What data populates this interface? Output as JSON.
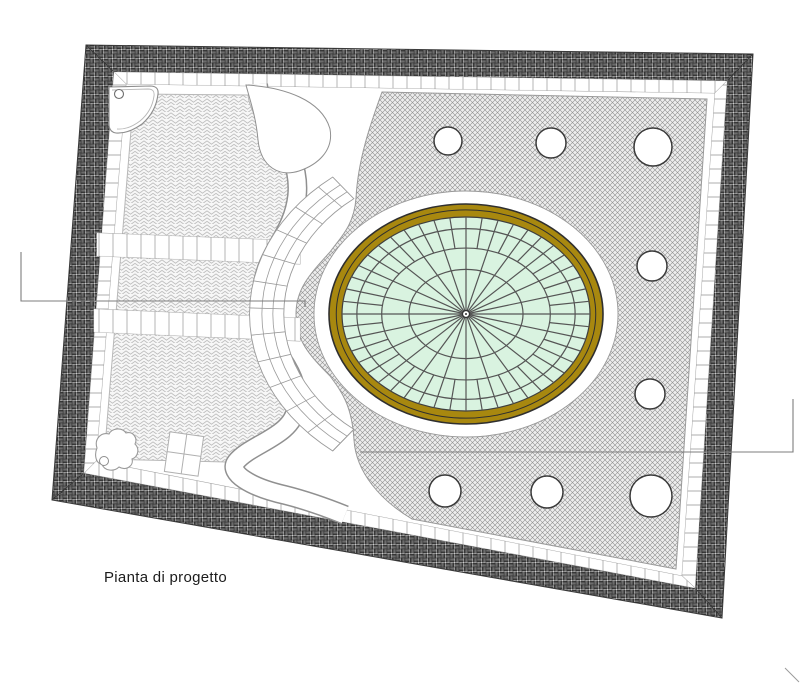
{
  "drawing": {
    "caption": "Pianta di progetto",
    "caption_pos": [
      104,
      569
    ],
    "colors": {
      "line": "#3a3a3a",
      "weave": "#222222",
      "weave_bg": "#f4f4f4",
      "hatch_line": "#8f8f8f",
      "hatch_bg": "#ededed",
      "herringbone_line": "#bdbdbd",
      "herringbone_bg": "#f7f7f7",
      "paver_joint": "#a3a3a3",
      "path_gray": "#909090",
      "soft_gray": "#b8b8b8",
      "ring_brown": "#A8880F",
      "ring_outline": "#2f2f2f",
      "dome_green": "#D9F3E0",
      "web_line": "#555555",
      "leader_gray": "#7d7d7d",
      "white": "#ffffff"
    },
    "outer_quad": [
      [
        86,
        45
      ],
      [
        753,
        54
      ],
      [
        722,
        618
      ],
      [
        52,
        500
      ]
    ],
    "inner_quad": [
      [
        114,
        72
      ],
      [
        727,
        81
      ],
      [
        695,
        588
      ],
      [
        84,
        473
      ]
    ],
    "content_quad": [
      [
        126,
        84
      ],
      [
        715,
        93
      ],
      [
        682,
        576
      ],
      [
        96,
        461
      ]
    ],
    "ellipse": {
      "cx": 466,
      "cy": 314,
      "ring_rx": 137,
      "ring_ry": 110,
      "inner_line_scale": 0.947,
      "green_rx": 124,
      "green_ry": 97,
      "white_rx": 152,
      "white_ry": 123,
      "web_rings": [
        0.46,
        0.68,
        0.88
      ],
      "spokes": 24,
      "sub_spokes_from": 0.68,
      "hub_radius": 3.5
    },
    "walkway": {
      "scale_in": 1.33,
      "scale_out": 1.58,
      "mid_scales": [
        1.41,
        1.49
      ],
      "deg_start": 128,
      "deg_end": 232,
      "joint_step": 9
    },
    "tree_circles": [
      [
        448,
        141,
        14
      ],
      [
        551,
        143,
        15
      ],
      [
        653,
        147,
        19
      ],
      [
        652,
        266,
        15
      ],
      [
        650,
        394,
        15
      ],
      [
        445,
        491,
        16
      ],
      [
        547,
        492,
        16
      ],
      [
        651,
        496,
        21
      ]
    ],
    "leaders": {
      "left": [
        [
          21,
          252
        ],
        [
          21,
          301
        ],
        [
          305,
          301
        ],
        [
          305,
          307
        ]
      ],
      "right": [
        [
          360,
          452
        ],
        [
          793,
          452
        ],
        [
          793,
          399
        ]
      ]
    },
    "corner_tick": [
      [
        785,
        668
      ],
      [
        799,
        682
      ]
    ],
    "pond_circle": [
      119,
      94,
      4.5
    ],
    "bush_circle": [
      104,
      461,
      4.5
    ],
    "planter": {
      "cx": 184,
      "cy": 454,
      "w": 34,
      "h": 40,
      "rotation": 8
    }
  }
}
